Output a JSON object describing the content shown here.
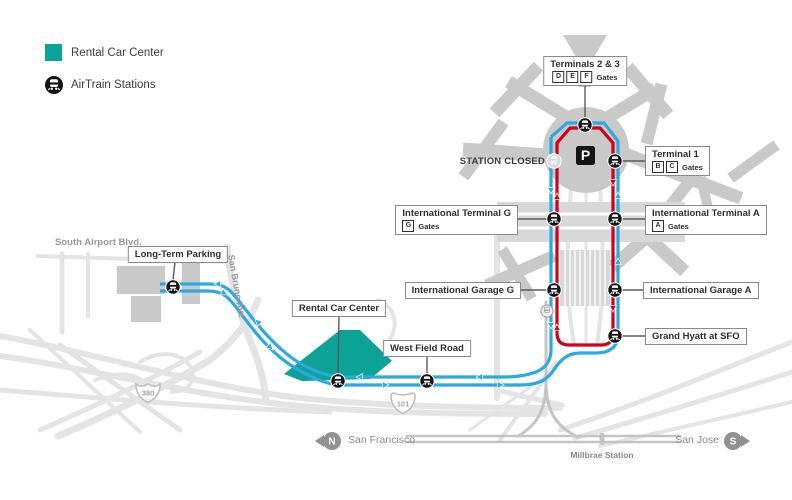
{
  "legend": {
    "items": [
      {
        "label": "Rental Car Center"
      },
      {
        "label": "AirTrain Stations"
      }
    ]
  },
  "stations": {
    "terminals23": {
      "title": "Terminals 2 & 3",
      "gates": [
        "D",
        "E",
        "F"
      ],
      "gates_word": "Gates"
    },
    "terminal1": {
      "title": "Terminal 1",
      "gates": [
        "B",
        "C"
      ],
      "gates_word": "Gates"
    },
    "intl_terminal_g": {
      "title": "International Terminal G",
      "gates": [
        "G"
      ],
      "gates_word": "Gates"
    },
    "intl_terminal_a": {
      "title": "International Terminal A",
      "gates": [
        "A"
      ],
      "gates_word": "Gates"
    },
    "intl_garage_g": {
      "title": "International Garage G"
    },
    "intl_garage_a": {
      "title": "International Garage A"
    },
    "grand_hyatt": {
      "title": "Grand Hyatt at SFO"
    },
    "long_term_parking": {
      "title": "Long-Term Parking"
    },
    "rental_car_center": {
      "title": "Rental Car Center"
    },
    "west_field_road": {
      "title": "West Field Road"
    }
  },
  "map_texts": {
    "station_closed": "STATION CLOSED",
    "south_airport_blvd": "South Airport Blvd.",
    "san_bruno_ave": "San Bruno Ave",
    "parking_symbol": "P"
  },
  "highways": {
    "i380": "380",
    "us101": "101"
  },
  "rail_corridor": {
    "north_badge": "N",
    "north_dest": "San Francisco",
    "south_dest": "San Jose",
    "south_badge": "S",
    "station": "Millbrae Station"
  },
  "colors": {
    "airtrain_blue": "#2BA9E0",
    "airtrain_red": "#D0021B",
    "rental_teal": "#0CA296",
    "station_black": "#141414",
    "building_gray": "#C9C9C9",
    "road_gray": "#E4E4E4",
    "rail_gray": "#C4C4C4"
  }
}
